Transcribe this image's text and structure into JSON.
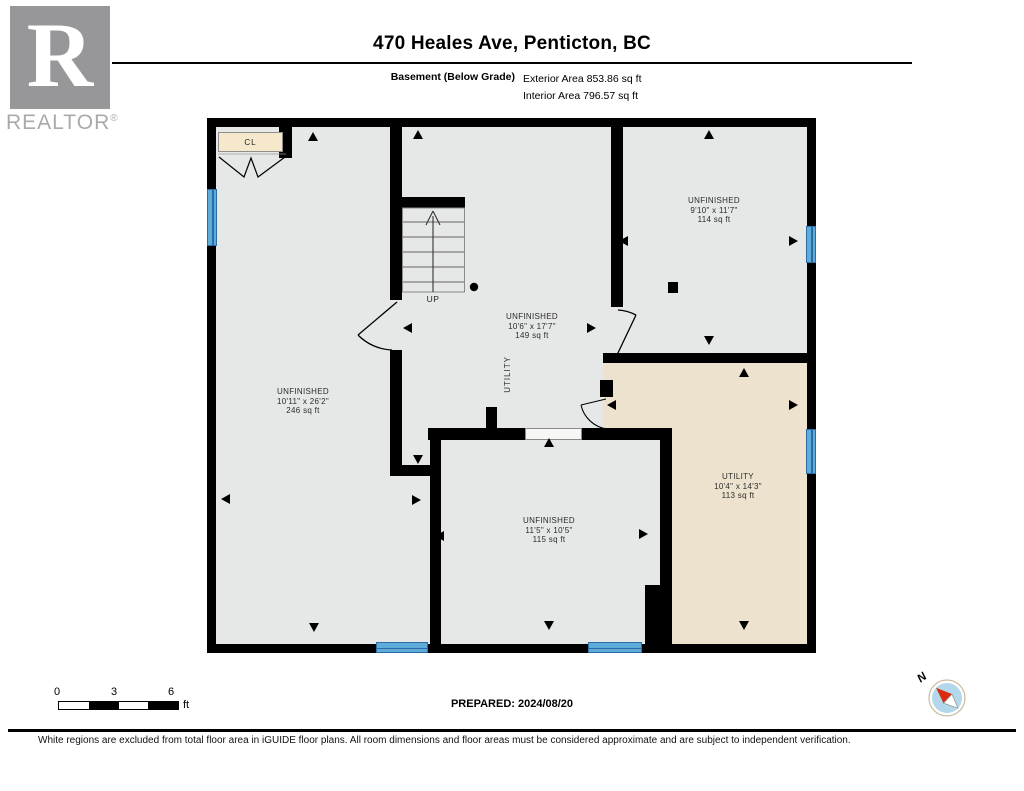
{
  "header": {
    "title": "470 Heales Ave, Penticton, BC",
    "floor_label": "Basement (Below Grade)",
    "exterior_area": "Exterior Area 853.86 sq ft",
    "interior_area": "Interior Area 796.57 sq ft"
  },
  "logo": {
    "letter": "R",
    "wordmark": "REALTOR",
    "registered_mark": "®"
  },
  "floor_plan": {
    "rooms": [
      {
        "id": "room-left",
        "name": "UNFINISHED",
        "dimensions": "10'11\" x 26'2\"",
        "area": "246 sq ft"
      },
      {
        "id": "room-middle",
        "name": "UNFINISHED",
        "dimensions": "10'6\" x 17'7\"",
        "area": "149 sq ft"
      },
      {
        "id": "room-top-right",
        "name": "UNFINISHED",
        "dimensions": "9'10\" x 11'7\"",
        "area": "114 sq ft"
      },
      {
        "id": "room-utility",
        "name": "UTILITY",
        "dimensions": "10'4\" x 14'3\"",
        "area": "113 sq ft"
      },
      {
        "id": "room-bottom",
        "name": "UNFINISHED",
        "dimensions": "11'5\" x 10'5\"",
        "area": "115 sq ft"
      }
    ],
    "annotations": {
      "up": "UP",
      "closet": "CL",
      "utility_corridor": "UTILITY"
    }
  },
  "scale_bar": {
    "tick0": "0",
    "tick1": "3",
    "tick2": "6",
    "unit": "ft"
  },
  "prepared_label": "PREPARED: 2024/08/20",
  "compass": {
    "north_label": "N"
  },
  "footer": {
    "disclaimer": "White regions are excluded from total floor area in iGUIDE floor plans. All room dimensions and floor areas must be considered approximate and are subject to independent verification."
  },
  "colors": {
    "wall": "#000000",
    "room_fill": "#e6e7e7",
    "utility_fill": "#ece2cd",
    "closet_fill": "#f6e9cb",
    "window_blue": "#5fabd9",
    "window_line": "#2a6da6",
    "compass_blue": "#b3d8eb",
    "compass_red": "#d92b0f",
    "logo_gray": "#97979a"
  }
}
